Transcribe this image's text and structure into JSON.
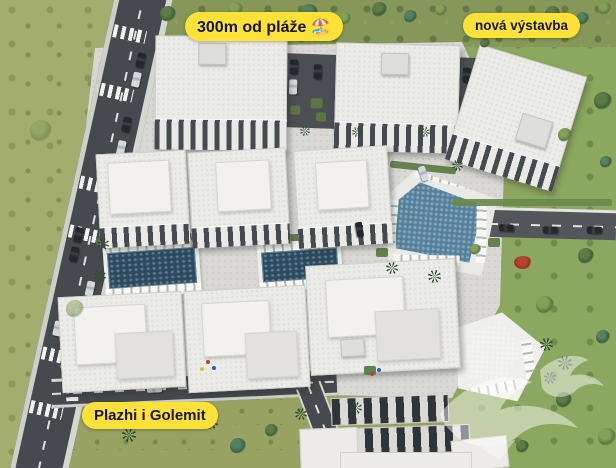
{
  "labels": {
    "beach_distance": "300m od pláže 🏖️",
    "new_construction": "nová výstavba",
    "beach_name": "Plazhi i Golemit"
  },
  "colors": {
    "label_bg": "#FFE235",
    "label_text": "#141414",
    "grass": "#97A263",
    "grass_left_field": "#A3AD6F",
    "grass_right": "#8CA75F",
    "road_asphalt": "#46494D",
    "sidewalk": "#CDD0CA",
    "paving": "#D9D8D4",
    "building_roof": "#EBEBE8",
    "pool_dark_blue": "#2C4B60",
    "pool_teal": "#55809C",
    "pool_bright_blue": "#4C83A6",
    "hedge_green": "#5C7A44",
    "watermark_white": "rgba(255,255,255,0.5)"
  },
  "icons": {
    "watermark": "swallow-birds-watermark-icon",
    "beach_emoji_in_label": "🏖️"
  }
}
